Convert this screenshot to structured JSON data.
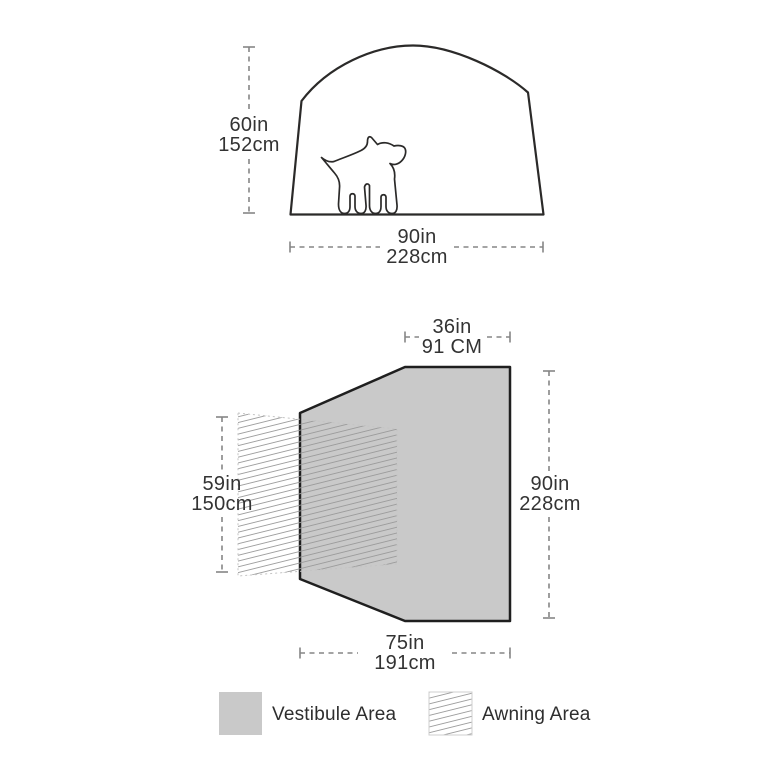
{
  "title": "Tent dimensions diagram",
  "colors": {
    "vestibule_fill": "#c9c9c9",
    "outline": "#2b2a29",
    "dim_line": "#858585",
    "hatch_line": "#9b9b9b",
    "text": "#333333"
  },
  "tent_diagram": {
    "height_dim": {
      "in": "60in",
      "cm": "152cm"
    },
    "width_dim": {
      "in": "90in",
      "cm": "228cm"
    }
  },
  "floor_plan": {
    "top_dim": {
      "in": "36in",
      "cm": "91 CM"
    },
    "right_dim": {
      "in": "90in",
      "cm": "228cm"
    },
    "left_dim": {
      "in": "59in",
      "cm": "150cm"
    },
    "bottom_dim": {
      "in": "75in",
      "cm": "191cm"
    }
  },
  "legend": {
    "vestibule_label": "Vestibule Area",
    "awning_label": "Awning Area"
  }
}
